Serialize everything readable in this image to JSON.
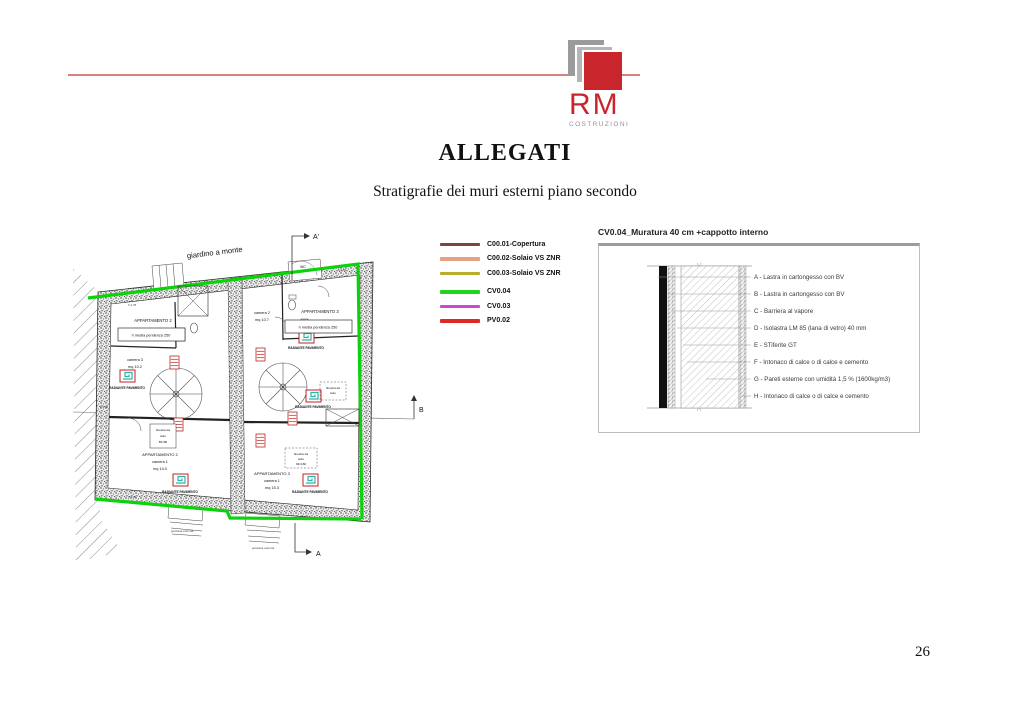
{
  "logo": {
    "name": "RM",
    "tagline": "COSTRUZIONI"
  },
  "header": {
    "title": "ALLEGATI",
    "subtitle": "Stratigrafie dei muri esterni piano secondo"
  },
  "page_number": "26",
  "colors": {
    "logo_red": "#c9252c",
    "rule_pink": "#d4827f",
    "green_wall": "#0bd20b"
  },
  "legend": {
    "items": [
      {
        "label": "C00.01-Copertura",
        "color": "#7a4441"
      },
      {
        "label": "C00.02-Solaio VS ZNR",
        "color": "#e6a183"
      },
      {
        "label": "C00.03-Solaio VS ZNR",
        "color": "#b9ad2e"
      },
      {
        "label": "CV0.04",
        "color": "#22d422"
      },
      {
        "label": "CV0.03",
        "color": "#cd46cd"
      },
      {
        "label": "PV0.02",
        "color": "#dc2b22"
      }
    ]
  },
  "detail": {
    "title": "CV0.04_Muratura 40 cm +cappotto interno",
    "layers": [
      "A - Lastra in cartongesso con BV",
      "B - Lastra in cartongesso con BV",
      "C - Barriera al vapore",
      "D - Isolastra LM 85 (lana di vetro) 40 mm",
      "E - STiferite GT",
      "F - Intonaco di calce o di calce e cemento",
      "G - Pareti esterne con umidità 1,5 % (1600kg/m3)",
      "H - Intonaco di calce o di calce e cemento"
    ]
  },
  "plan": {
    "garden_label": "giardino a monte",
    "apartment2": "APPARTAMENTO 2",
    "apartment3": "APPARTAMENTO 3",
    "pendenza": "h media pendenza 250",
    "camera3": "camera 3",
    "camera3_mq": "mq 10.2",
    "camera2": "camera 2",
    "camera2_mq": "mq 10.7",
    "camera1": "camera 1",
    "camera1_mq": "mq 14.0",
    "camera1b_mq": "mq 15.3",
    "radiante": "RADIANTE PAVIMENTO",
    "finestra_line1": "finestra da",
    "finestra_line2": "tetto",
    "finestra_size1": "80×80",
    "finestra_size2": "94×160",
    "persiana": "persiana esterna",
    "wc": "WC",
    "elev_278": "h 2.78",
    "elev_255": "h 2.55",
    "elev_300": "h 3.00",
    "marker_top": "A'",
    "marker_bottom": "A",
    "marker_right": "B"
  }
}
